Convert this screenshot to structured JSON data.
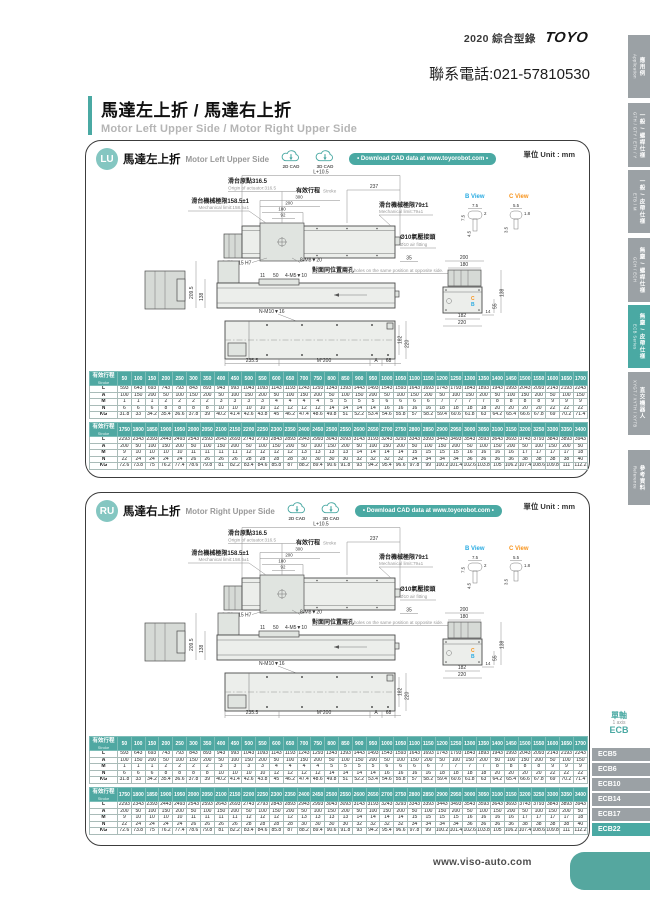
{
  "page": {
    "brand_year": "2020 綜合型錄",
    "brand_logo": "TOYO",
    "phone": "聯系電話:021-57810530",
    "title": "馬達左上折 / 馬達右上折",
    "subtitle": "Motor Left Upper Side / Motor Right Upper Side",
    "footer_url": "www.viso-auto.com",
    "unit_label": "單位 Unit : mm"
  },
  "sections": {
    "lu": {
      "code": "LU",
      "title_zh": "馬達左上折",
      "title_en": "Motor Left Upper Side"
    },
    "ru": {
      "code": "RU",
      "title_zh": "馬達右上折",
      "title_en": "Motor Right Upper Side"
    },
    "cad_2d": "2D CAD",
    "cad_3d": "3D CAD",
    "download": "• Download CAD data at www.toyorobot.com •"
  },
  "sidebar": {
    "tabs": [
      {
        "zh": "應用例",
        "en": "Application"
      },
      {
        "zh": "一般 / 螺桿仕樣",
        "en": "GTH / GTY / ETH / Y"
      },
      {
        "zh": "一般 / 皮帶仕樣",
        "en": "ETB / M"
      },
      {
        "zh": "無塵 / 螺桿仕樣",
        "en": "GCH / ECH"
      },
      {
        "zh": "無塵 / 皮帶仕樣",
        "en": "ECB Series"
      },
      {
        "zh": "直交機器人",
        "en": "XYGT / XYTH / XYTB"
      },
      {
        "zh": "參考資料",
        "en": "Reference"
      }
    ],
    "ecb": {
      "group_zh": "單軸",
      "group_en": "1 axis",
      "group_code": "ECB",
      "items": [
        "ECB5",
        "ECB6",
        "ECB10",
        "ECB14",
        "ECB17",
        "ECB22"
      ],
      "active_item": "ECB22"
    }
  },
  "drawing": {
    "dim_total": "L+10.5",
    "origin_zh": "滑台原點316.5",
    "origin_en": "Origin of actuator:316.5",
    "stroke_zh": "有效行程",
    "stroke_en": "Stroke",
    "dim_237": "237",
    "mech_left_zh": "滑台機械極限158.5±1",
    "mech_left_en": "Mechanical limit:158.5±1",
    "mech_right_zh": "滑台機械極限79±1",
    "mech_right_en": "Mechanical limit:79±1",
    "stack_300": "300",
    "stack_200": "200",
    "stack_180": "180",
    "stack_92": "92",
    "air_zh": "Ø10氣壓接頭",
    "air_en": "Ø10 air fitting",
    "dim_35": "35",
    "holes_dowel": "2-Ø8▼15 H7",
    "holes_m8": "8-M8▼20",
    "opp_zh": "對面同位置兩孔",
    "opp_en": "2 holes on the same position at opposite side.",
    "dim_11": "11",
    "dim_50": "50",
    "holes_m5": "4-M5▼10",
    "dim_209_5": "209.5",
    "dim_138": "138",
    "holes_m10": "N-M10▼16",
    "dim_235_5": "235.5",
    "dim_m200": "M*200",
    "dim_A": "A",
    "dim_68": "68",
    "b_view": "B View",
    "c_view": "C View",
    "b_75": "7.5",
    "b_2": "2",
    "b_75s": "7.5",
    "b_45": "4.5",
    "c_55": "5.5",
    "c_18": "1.8",
    "c_35": "3.5",
    "ev_200": "200",
    "ev_180": "180",
    "ev_138": "138",
    "ev_55": "55",
    "ev_14": "14",
    "ev_182": "182",
    "ev_220": "220",
    "marker_c": "C",
    "marker_b": "B"
  },
  "table_meta": {
    "header_zh": "有效行程",
    "header_en": "Stroke"
  },
  "tables": {
    "part1": {
      "strokes": [
        50,
        100,
        150,
        200,
        250,
        300,
        350,
        400,
        450,
        500,
        550,
        600,
        650,
        700,
        750,
        800,
        850,
        900,
        950,
        1000,
        1050,
        1100,
        1150,
        1200,
        1250,
        1300,
        1350,
        1400,
        1450,
        1500,
        1550,
        1600,
        1650,
        1700
      ],
      "rows": [
        {
          "label": "L",
          "values": [
            593,
            643,
            693,
            743,
            793,
            843,
            893,
            943,
            993,
            1043,
            1093,
            1143,
            1193,
            1243,
            1293,
            1343,
            1393,
            1443,
            1493,
            1543,
            1593,
            1643,
            1693,
            1743,
            1793,
            1843,
            1893,
            1943,
            1993,
            2043,
            2093,
            2143,
            2193,
            2243
          ]
        },
        {
          "label": "A",
          "values": [
            100,
            150,
            200,
            50,
            100,
            150,
            200,
            50,
            100,
            150,
            200,
            50,
            100,
            150,
            200,
            50,
            100,
            150,
            200,
            50,
            100,
            150,
            200,
            50,
            100,
            150,
            200,
            50,
            100,
            150,
            200,
            50,
            100,
            150
          ]
        },
        {
          "label": "M",
          "values": [
            1,
            1,
            1,
            2,
            2,
            2,
            2,
            3,
            3,
            3,
            3,
            4,
            4,
            4,
            4,
            5,
            5,
            5,
            5,
            6,
            6,
            6,
            6,
            7,
            7,
            7,
            7,
            8,
            8,
            8,
            8,
            9,
            9,
            9
          ]
        },
        {
          "label": "N",
          "values": [
            6,
            6,
            6,
            8,
            8,
            8,
            8,
            10,
            10,
            10,
            10,
            12,
            12,
            12,
            12,
            14,
            14,
            14,
            14,
            16,
            16,
            16,
            16,
            18,
            18,
            18,
            18,
            20,
            20,
            20,
            20,
            22,
            22,
            22
          ]
        },
        {
          "label": "KG",
          "values": [
            31.8,
            33,
            34.2,
            35.4,
            36.6,
            37.8,
            39,
            40.2,
            41.4,
            42.6,
            43.8,
            45,
            46.2,
            47.4,
            48.6,
            49.8,
            51,
            52.2,
            53.4,
            54.6,
            55.8,
            57,
            58.2,
            59.4,
            60.6,
            61.8,
            63,
            64.2,
            65.4,
            66.6,
            67.8,
            69,
            70.2,
            71.4
          ]
        }
      ]
    },
    "part2": {
      "strokes": [
        1750,
        1800,
        1850,
        1900,
        1950,
        2000,
        2050,
        2100,
        2150,
        2200,
        2250,
        2300,
        2350,
        2400,
        2450,
        2500,
        2550,
        2600,
        2650,
        2700,
        2750,
        2800,
        2850,
        2900,
        2950,
        3000,
        3050,
        3100,
        3150,
        3200,
        3250,
        3300,
        3350,
        3400
      ],
      "rows": [
        {
          "label": "L",
          "values": [
            2293,
            2343,
            2393,
            2443,
            2493,
            2543,
            2593,
            2643,
            2693,
            2743,
            2793,
            2843,
            2893,
            2943,
            2993,
            3043,
            3093,
            3143,
            3193,
            3243,
            3293,
            3343,
            3393,
            3443,
            3493,
            3543,
            3593,
            3643,
            3693,
            3743,
            3793,
            3843,
            3893,
            3943
          ]
        },
        {
          "label": "A",
          "values": [
            200,
            50,
            100,
            150,
            200,
            50,
            100,
            150,
            200,
            50,
            100,
            150,
            200,
            50,
            100,
            150,
            200,
            50,
            100,
            150,
            200,
            50,
            100,
            150,
            200,
            50,
            100,
            150,
            200,
            50,
            100,
            150,
            200,
            50
          ]
        },
        {
          "label": "M",
          "values": [
            9,
            10,
            10,
            10,
            10,
            11,
            11,
            11,
            11,
            12,
            12,
            12,
            12,
            13,
            13,
            13,
            13,
            14,
            14,
            14,
            14,
            15,
            15,
            15,
            15,
            16,
            16,
            16,
            16,
            17,
            17,
            17,
            17,
            18
          ]
        },
        {
          "label": "N",
          "values": [
            22,
            24,
            24,
            24,
            24,
            26,
            26,
            26,
            26,
            28,
            28,
            28,
            28,
            30,
            30,
            30,
            30,
            32,
            32,
            32,
            32,
            34,
            34,
            34,
            34,
            36,
            36,
            36,
            36,
            38,
            38,
            38,
            38,
            40
          ]
        },
        {
          "label": "KG",
          "values": [
            72.6,
            73.8,
            75,
            76.2,
            77.4,
            78.6,
            79.8,
            81,
            82.2,
            83.4,
            84.6,
            85.8,
            87,
            88.2,
            89.4,
            90.6,
            91.8,
            93,
            94.2,
            95.4,
            96.6,
            97.8,
            99,
            100.2,
            101.4,
            102.6,
            103.8,
            105,
            106.2,
            107.4,
            108.6,
            109.8,
            111,
            112.2
          ]
        }
      ]
    }
  },
  "colors": {
    "teal": "#4aa9a3",
    "tab_gray": "#9ba1a5",
    "b_view_blue": "#29abe2",
    "c_view_orange": "#f7941d"
  }
}
